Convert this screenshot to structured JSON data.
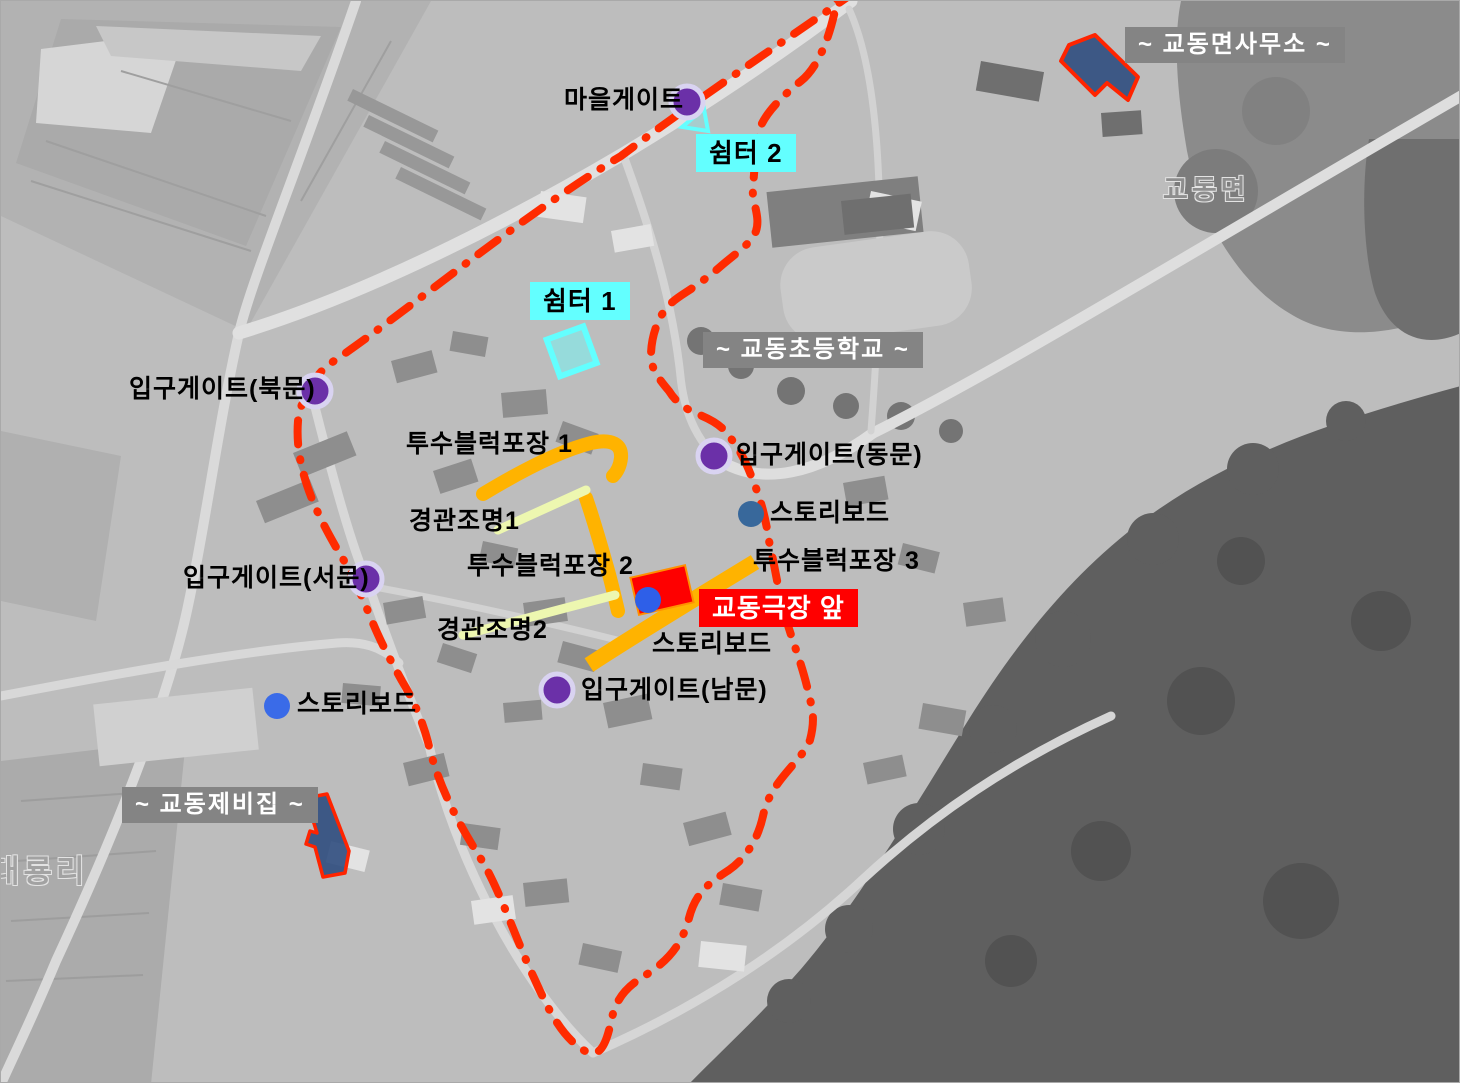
{
  "base_map": {
    "place_labels": {
      "village_name": "대룡리",
      "town_name": "교동면"
    }
  },
  "landmarks": {
    "myeon_office": "~ 교동면사무소 ~",
    "elementary_school": "~ 교동초등학교 ~",
    "jebi_house": "~ 교동제비집 ~"
  },
  "highlight": {
    "theater_front": "교동극장 앞"
  },
  "shelters": [
    {
      "id": "shelter-1",
      "text": "쉼터 1"
    },
    {
      "id": "shelter-2",
      "text": "쉼터 2"
    }
  ],
  "gates": [
    {
      "id": "village-gate",
      "text": "마을게이트"
    },
    {
      "id": "north-gate",
      "text": "입구게이트(북문)"
    },
    {
      "id": "east-gate",
      "text": "입구게이트(동문)"
    },
    {
      "id": "west-gate",
      "text": "입구게이트(서문)"
    },
    {
      "id": "south-gate",
      "text": "입구게이트(남문)"
    }
  ],
  "pavements": [
    {
      "id": "pavement-1",
      "text": "투수블럭포장 1"
    },
    {
      "id": "pavement-2",
      "text": "투수블럭포장 2"
    },
    {
      "id": "pavement-3",
      "text": "투수블럭포장 3"
    }
  ],
  "lighting": [
    {
      "id": "lighting-1",
      "text": "경관조명1"
    },
    {
      "id": "lighting-2",
      "text": "경관조명2"
    }
  ],
  "storyboards": [
    {
      "id": "storyboard-east",
      "text": "스토리보드"
    },
    {
      "id": "storyboard-center",
      "text": "스토리보드"
    },
    {
      "id": "storyboard-west",
      "text": "스토리보드"
    }
  ],
  "colors": {
    "boundary_line": "#ff2b00",
    "pavement_path": "#ffb300",
    "lighting_line": "#edf7b0",
    "gate_dot": "#6b30a8",
    "gate_dot_ring": "#d9d3f1",
    "storyboard_dot_blue": "#3a6be8",
    "storyboard_dot_steel": "#38689b",
    "shelter_cyan": "#63ffff",
    "landmark_box_gray": "#848484",
    "highlight_box_red": "#ff0000",
    "marked_building_fill": "#2f4c7e",
    "marked_building_outline": "#ff2400"
  }
}
